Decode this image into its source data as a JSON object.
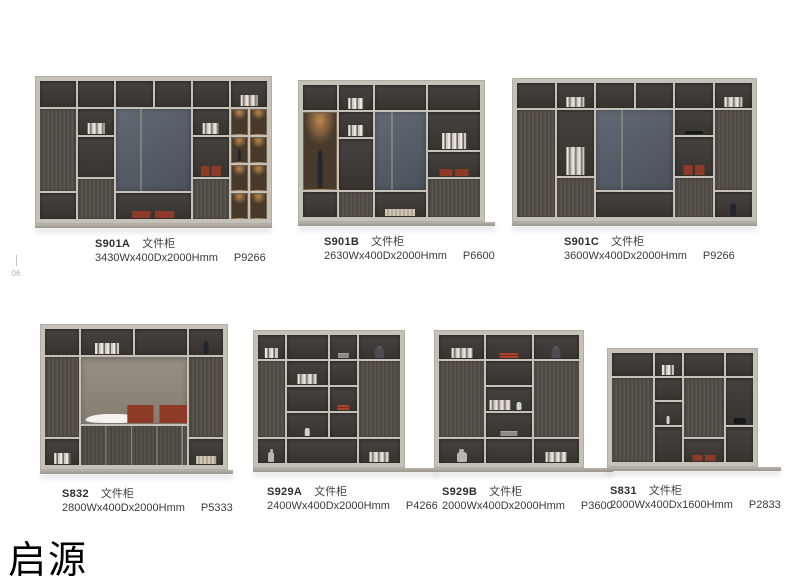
{
  "page": {
    "brand": "启源",
    "side_marker": "06"
  },
  "products": [
    {
      "model": "S901A",
      "category": "文件柜",
      "dimensions": "3430Wx400Dx2000Hmm",
      "code": "P9266",
      "figure": {
        "cols": 12,
        "rows": 10,
        "cells": [
          [
            1,
            1,
            2,
            2,
            "o"
          ],
          [
            1,
            3,
            2,
            6,
            "w"
          ],
          [
            1,
            9,
            2,
            2,
            "o"
          ],
          [
            3,
            1,
            2,
            2,
            "o"
          ],
          [
            3,
            3,
            2,
            2,
            "o",
            "books"
          ],
          [
            3,
            5,
            2,
            3,
            "o"
          ],
          [
            3,
            8,
            2,
            3,
            "w"
          ],
          [
            5,
            1,
            2,
            2,
            "o"
          ],
          [
            7,
            1,
            2,
            2,
            "o"
          ],
          [
            5,
            3,
            4,
            6,
            "p"
          ],
          [
            5,
            9,
            4,
            2,
            "o",
            "box"
          ],
          [
            9,
            1,
            2,
            2,
            "o"
          ],
          [
            9,
            3,
            2,
            2,
            "o",
            "books"
          ],
          [
            9,
            5,
            2,
            3,
            "o",
            "box"
          ],
          [
            9,
            8,
            2,
            3,
            "w"
          ],
          [
            11,
            1,
            2,
            2,
            "o",
            "books"
          ],
          [
            11,
            3,
            1,
            2,
            "g"
          ],
          [
            12,
            3,
            1,
            2,
            "g"
          ],
          [
            11,
            5,
            1,
            2,
            "g",
            "vase"
          ],
          [
            12,
            5,
            1,
            2,
            "g"
          ],
          [
            11,
            7,
            1,
            2,
            "g"
          ],
          [
            12,
            7,
            1,
            2,
            "g"
          ],
          [
            11,
            9,
            1,
            2,
            "g"
          ],
          [
            12,
            9,
            1,
            2,
            "g"
          ]
        ]
      }
    },
    {
      "model": "S901B",
      "category": "文件柜",
      "dimensions": "2630Wx400Dx2000Hmm",
      "code": "P6600",
      "figure": {
        "cols": 10,
        "rows": 10,
        "cells": [
          [
            1,
            1,
            2,
            2,
            "o"
          ],
          [
            1,
            3,
            2,
            6,
            "g",
            "vase"
          ],
          [
            1,
            9,
            2,
            2,
            "o"
          ],
          [
            3,
            1,
            2,
            2,
            "o",
            "books"
          ],
          [
            3,
            3,
            2,
            2,
            "o",
            "books"
          ],
          [
            3,
            5,
            2,
            4,
            "o"
          ],
          [
            3,
            9,
            2,
            2,
            "w"
          ],
          [
            5,
            1,
            3,
            2,
            "o"
          ],
          [
            5,
            3,
            3,
            6,
            "p"
          ],
          [
            5,
            9,
            3,
            2,
            "o",
            "basket"
          ],
          [
            8,
            1,
            3,
            2,
            "o"
          ],
          [
            8,
            3,
            3,
            3,
            "o",
            "books"
          ],
          [
            8,
            6,
            3,
            2,
            "o",
            "box"
          ],
          [
            8,
            8,
            3,
            3,
            "w"
          ]
        ]
      }
    },
    {
      "model": "S901C",
      "category": "文件柜",
      "dimensions": "3600Wx400Dx2000Hmm",
      "code": "P9266",
      "figure": {
        "cols": 12,
        "rows": 10,
        "cells": [
          [
            1,
            1,
            2,
            2,
            "o"
          ],
          [
            1,
            3,
            2,
            8,
            "w"
          ],
          [
            3,
            1,
            2,
            2,
            "o",
            "books"
          ],
          [
            3,
            3,
            2,
            5,
            "o",
            "books"
          ],
          [
            3,
            8,
            2,
            3,
            "w"
          ],
          [
            5,
            1,
            2,
            2,
            "o"
          ],
          [
            7,
            1,
            2,
            2,
            "o"
          ],
          [
            5,
            3,
            4,
            6,
            "p"
          ],
          [
            5,
            9,
            4,
            2,
            "o"
          ],
          [
            9,
            1,
            2,
            2,
            "o"
          ],
          [
            9,
            3,
            2,
            2,
            "o",
            "black"
          ],
          [
            9,
            5,
            2,
            3,
            "o",
            "box"
          ],
          [
            9,
            8,
            2,
            3,
            "w"
          ],
          [
            11,
            1,
            2,
            2,
            "o",
            "books"
          ],
          [
            11,
            3,
            2,
            6,
            "w"
          ],
          [
            11,
            9,
            2,
            2,
            "o",
            "vase"
          ]
        ]
      }
    },
    {
      "model": "S832",
      "category": "文件柜",
      "dimensions": "2800Wx400Dx2000Hmm",
      "code": "P5333",
      "figure": {
        "cols": 10,
        "rows": 10,
        "cells": [
          [
            1,
            1,
            2,
            2,
            "o"
          ],
          [
            1,
            3,
            2,
            6,
            "w"
          ],
          [
            1,
            9,
            2,
            2,
            "o",
            "books"
          ],
          [
            3,
            1,
            3,
            2,
            "o",
            "books"
          ],
          [
            6,
            1,
            3,
            2,
            "o"
          ],
          [
            3,
            3,
            6,
            5,
            "l",
            [
              "bowl@l",
              "box@r"
            ]
          ],
          [
            3,
            8,
            6,
            3,
            "d"
          ],
          [
            9,
            1,
            2,
            2,
            "o",
            "vase"
          ],
          [
            9,
            3,
            2,
            6,
            "w"
          ],
          [
            9,
            9,
            2,
            2,
            "o",
            "basket"
          ]
        ]
      }
    },
    {
      "model": "S929A",
      "category": "文件柜",
      "dimensions": "2400Wx400Dx2000Hmm",
      "code": "P4266",
      "figure": {
        "cols": 10,
        "rows": 10,
        "cells": [
          [
            1,
            1,
            2,
            2,
            "o",
            "books"
          ],
          [
            1,
            3,
            2,
            6,
            "w"
          ],
          [
            1,
            9,
            2,
            2,
            "o",
            "robot"
          ],
          [
            3,
            1,
            3,
            2,
            "o"
          ],
          [
            6,
            1,
            2,
            2,
            "o",
            "binder"
          ],
          [
            3,
            3,
            3,
            2,
            "o",
            "books"
          ],
          [
            3,
            5,
            3,
            2,
            "o"
          ],
          [
            3,
            7,
            3,
            2,
            "o",
            "bottle"
          ],
          [
            6,
            3,
            2,
            2,
            "o"
          ],
          [
            6,
            5,
            2,
            2,
            "o",
            "stack"
          ],
          [
            6,
            7,
            2,
            2,
            "o"
          ],
          [
            3,
            9,
            5,
            2,
            "o"
          ],
          [
            8,
            1,
            3,
            2,
            "o",
            "toy"
          ],
          [
            8,
            3,
            3,
            6,
            "w"
          ],
          [
            8,
            9,
            3,
            2,
            "o",
            "books"
          ]
        ]
      }
    },
    {
      "model": "S929B",
      "category": "文件柜",
      "dimensions": "2000Wx400Dx2000Hmm",
      "code": "P3600",
      "figure": {
        "cols": 9,
        "rows": 10,
        "cells": [
          [
            1,
            1,
            3,
            2,
            "o",
            "books"
          ],
          [
            1,
            3,
            3,
            6,
            "w"
          ],
          [
            1,
            9,
            3,
            2,
            "o",
            "robot"
          ],
          [
            4,
            1,
            3,
            2,
            "o",
            "stack"
          ],
          [
            4,
            3,
            3,
            2,
            "o"
          ],
          [
            4,
            5,
            3,
            2,
            "o",
            [
              "books@l",
              "bottle@r"
            ]
          ],
          [
            4,
            7,
            3,
            2,
            "o",
            "binder"
          ],
          [
            4,
            9,
            3,
            2,
            "o"
          ],
          [
            7,
            1,
            3,
            2,
            "o",
            "toy"
          ],
          [
            7,
            3,
            3,
            6,
            "w"
          ],
          [
            7,
            9,
            3,
            2,
            "o",
            "books"
          ]
        ]
      }
    },
    {
      "model": "S831",
      "category": "文件柜",
      "dimensions": "2000Wx400Dx1600Hmm",
      "code": "P2833",
      "figure": {
        "cols": 10,
        "rows": 9,
        "cells": [
          [
            1,
            1,
            3,
            2,
            "o"
          ],
          [
            1,
            3,
            3,
            7,
            "w"
          ],
          [
            4,
            1,
            2,
            2,
            "o",
            "books"
          ],
          [
            4,
            3,
            2,
            2,
            "o"
          ],
          [
            4,
            5,
            2,
            2,
            "o",
            "bottle"
          ],
          [
            4,
            7,
            2,
            3,
            "o"
          ],
          [
            6,
            1,
            3,
            2,
            "o"
          ],
          [
            6,
            3,
            3,
            5,
            "w"
          ],
          [
            6,
            8,
            3,
            2,
            "o",
            "box"
          ],
          [
            9,
            1,
            2,
            2,
            "o"
          ],
          [
            9,
            3,
            2,
            4,
            "o",
            "black"
          ],
          [
            9,
            7,
            2,
            3,
            "o"
          ]
        ]
      }
    }
  ]
}
